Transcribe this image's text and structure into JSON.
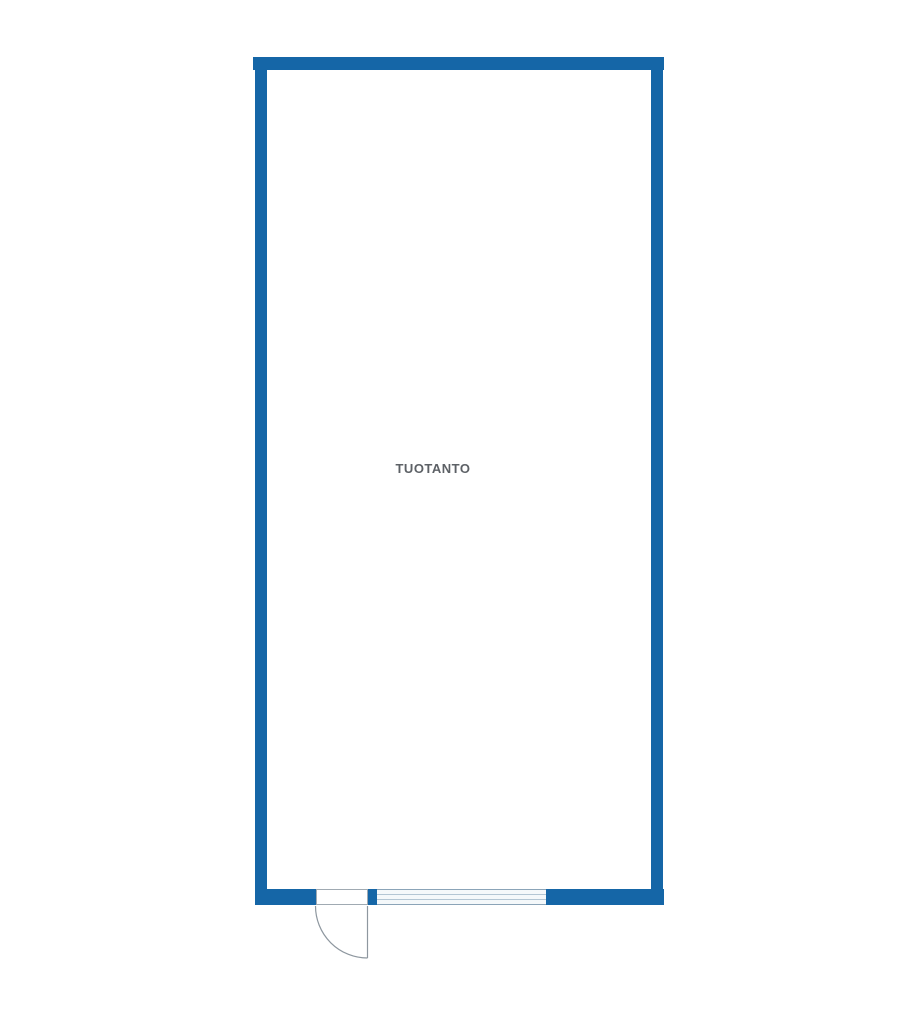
{
  "floor_plan": {
    "room": {
      "label": "TUOTANTO"
    },
    "colors": {
      "background": "#ffffff",
      "wall": "#1566a7",
      "door_line": "#8e979f",
      "frame_border": "#a0aab2",
      "window_line_outer": "#8ba4b8",
      "window_line_inner": "#b3c6d4",
      "label": "#5d6166"
    },
    "icons": {
      "door": "quarter-circle-swing-arc",
      "window": "four-line-strip"
    }
  }
}
